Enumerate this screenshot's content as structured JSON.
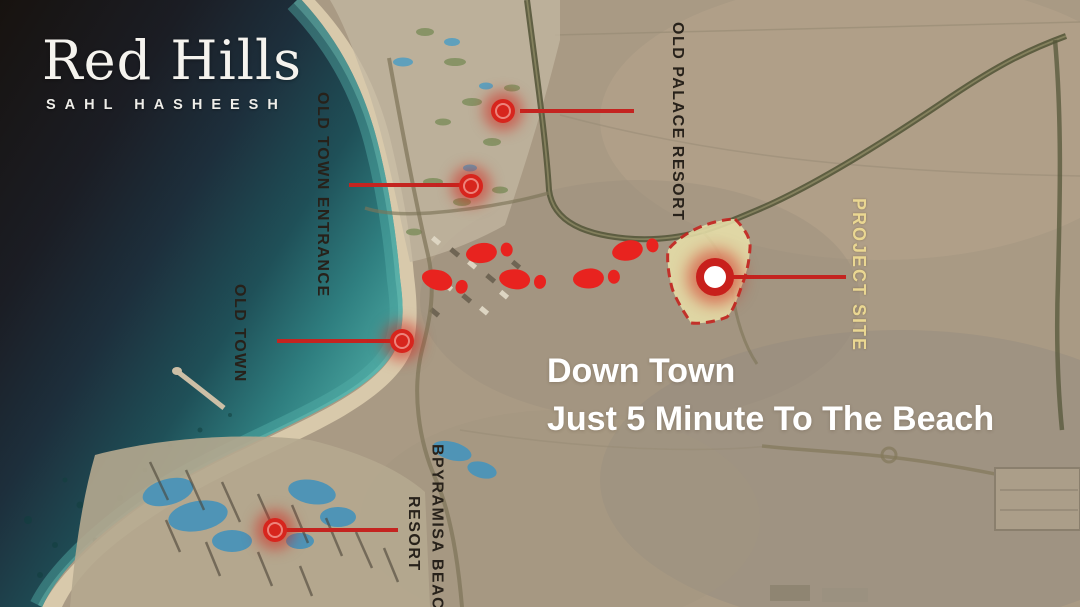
{
  "brand": {
    "name": "Red Hills",
    "tagline": "SAHL HASHEESH"
  },
  "map": {
    "labels": {
      "old_palace_resort": "OLD PALACE RESORT",
      "old_town_entrance": "OLD TOWN ENTRANCE",
      "old_town": "OLD TOWN",
      "pyramisa_line1": "BPYRAMISA BEACH",
      "pyramisa_line2": "RESORT",
      "project_site": "PROJECT SITE"
    },
    "markers": [
      {
        "id": "old-palace-resort-marker",
        "points_to": "OLD PALACE RESORT"
      },
      {
        "id": "old-town-entrance-marker",
        "points_to": "OLD TOWN ENTRANCE"
      },
      {
        "id": "old-town-marker",
        "points_to": "OLD TOWN"
      },
      {
        "id": "pyramisa-beach-resort-marker",
        "points_to": "BPYRAMISA BEACH RESORT"
      },
      {
        "id": "project-site-marker",
        "points_to": "PROJECT SITE"
      }
    ],
    "footprints_count": 5
  },
  "caption": {
    "line1": "Down Town",
    "line2": "Just 5 Minute To The Beach"
  },
  "colors": {
    "marker_red": "#d7251d",
    "connector_red": "#c42420",
    "footprint_red": "#e8231f",
    "project_site_fill": "#eae2ab",
    "project_site_border": "#c8201c",
    "project_site_label": "#ead792",
    "label_dark": "#27211a",
    "caption_white": "#ffffff"
  }
}
